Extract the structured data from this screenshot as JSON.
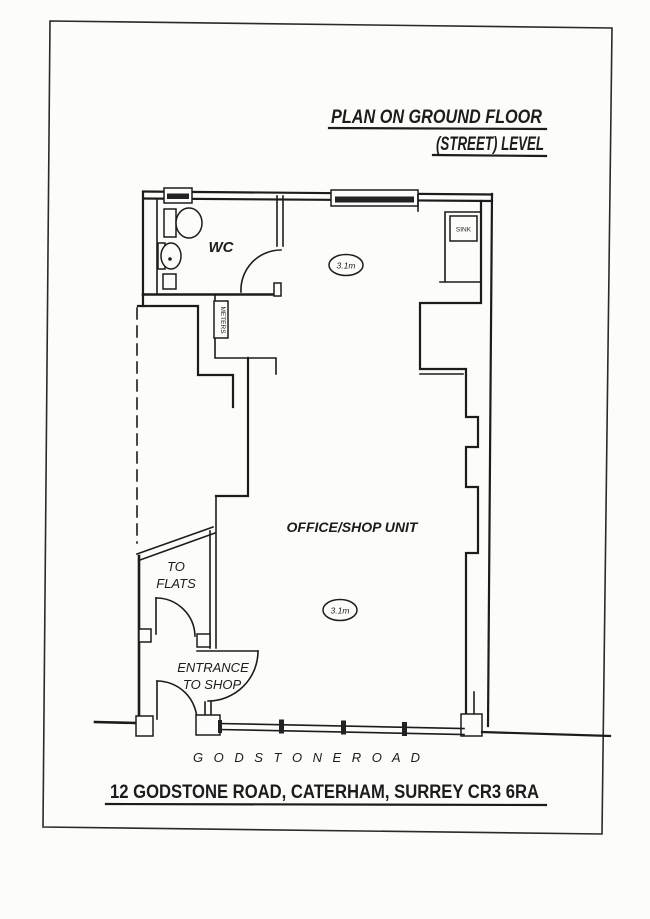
{
  "page": {
    "paper_color": "#fcfcfa",
    "ink_color": "#1c1c1c"
  },
  "title": {
    "line1": "PLAN ON GROUND FLOOR",
    "line2": "(STREET) LEVEL"
  },
  "plan": {
    "rooms": {
      "wc": "WC",
      "office_shop_unit": "OFFICE/SHOP UNIT",
      "to_flats_line1": "TO",
      "to_flats_line2": "FLATS",
      "entrance_line1": "ENTRANCE",
      "entrance_line2": "TO SHOP"
    },
    "fixtures": {
      "sink": "SINK",
      "meters": "METERS"
    },
    "dimensions": {
      "upper": "3.1m",
      "lower": "3.1m"
    }
  },
  "street": {
    "name": "G O D S T O N E    R O A D"
  },
  "footer": {
    "address": "12 GODSTONE ROAD, CATERHAM, SURREY CR3 6RA"
  }
}
